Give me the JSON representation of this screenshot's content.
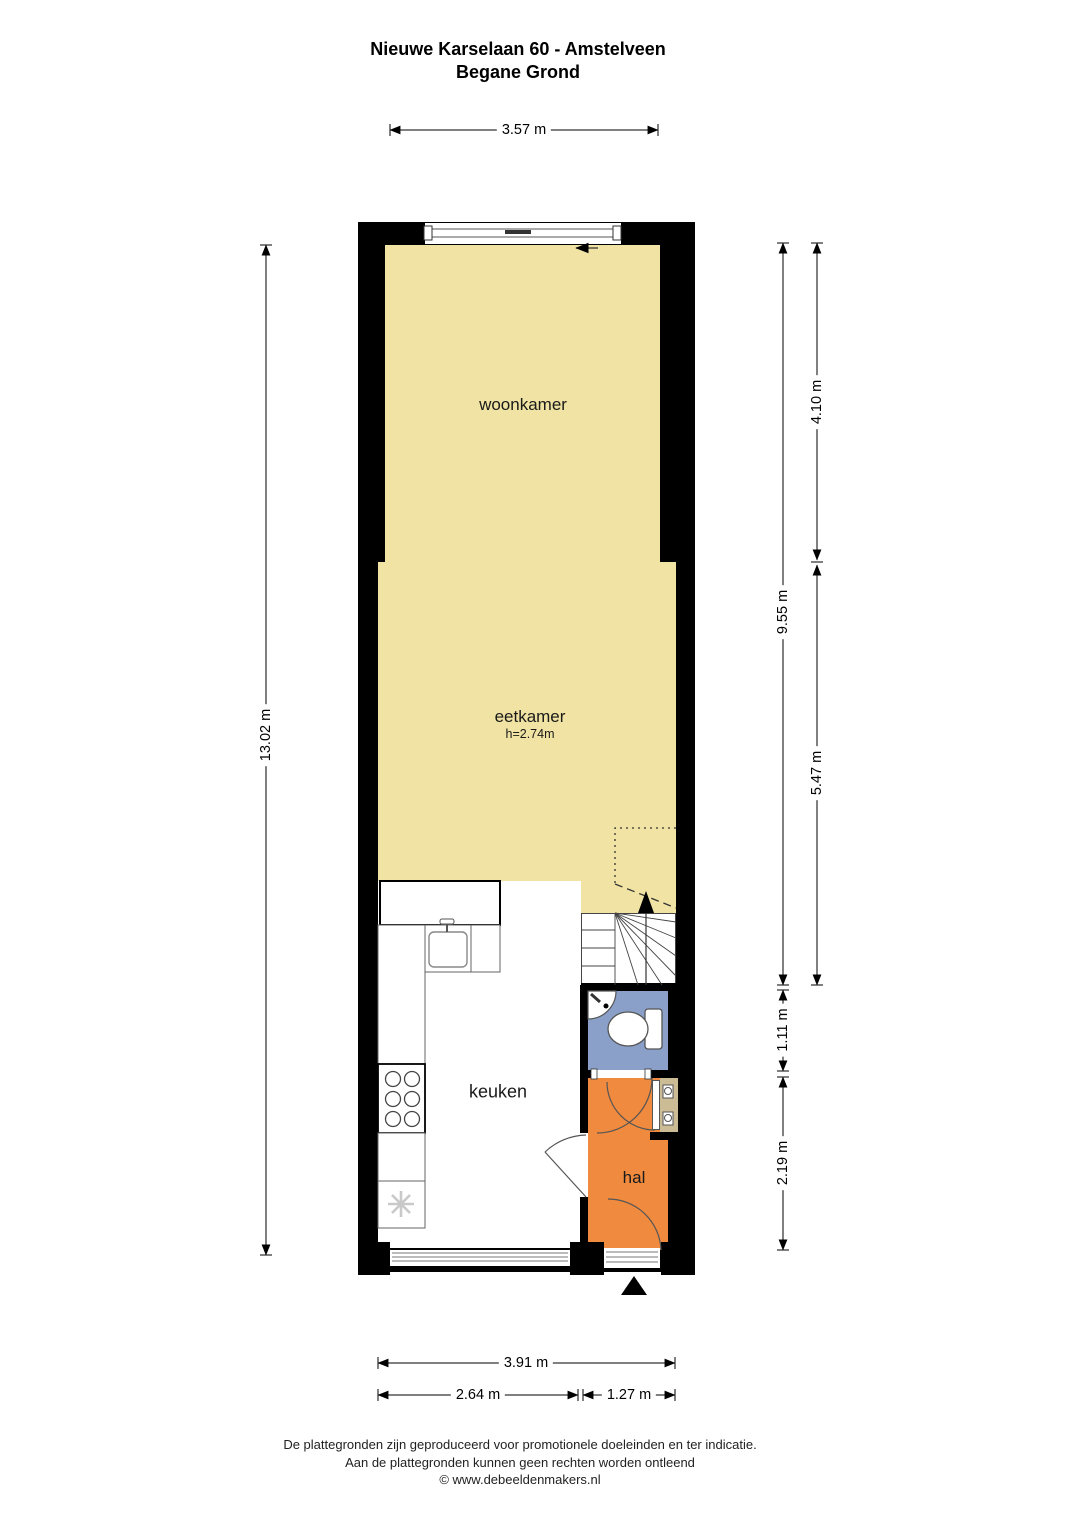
{
  "title": {
    "line1": "Nieuwe Karselaan 60 - Amstelveen",
    "line2": "Begane Grond"
  },
  "rooms": {
    "woonkamer": {
      "label": "woonkamer"
    },
    "eetkamer": {
      "label": "eetkamer",
      "height_note": "h=2.74m"
    },
    "keuken": {
      "label": "keuken"
    },
    "hal": {
      "label": "hal"
    }
  },
  "dimensions": {
    "top_width": "3.57 m",
    "left_total_height": "13.02 m",
    "right_inner_height": "9.55 m",
    "right_woonkamer_depth": "4.10 m",
    "right_eetkamer_depth": "5.47 m",
    "right_toilet_depth": "1.11 m",
    "right_hal_depth": "2.19 m",
    "bottom_inner_width": "3.91 m",
    "bottom_keuken_width": "2.64 m",
    "bottom_hal_width": "1.27 m"
  },
  "footer": {
    "line1": "De plattegronden zijn geproduceerd voor promotionele doeleinden en ter indicatie.",
    "line2": "Aan de plattegronden kunnen geen rechten worden ontleend",
    "line3": "© www.debeeldenmakers.nl"
  },
  "colors": {
    "room_main": "#f0e3a3",
    "toilet": "#8aa0c8",
    "hal": "#f08a3e",
    "meterkast": "#cbbc95",
    "wall": "#000000"
  }
}
